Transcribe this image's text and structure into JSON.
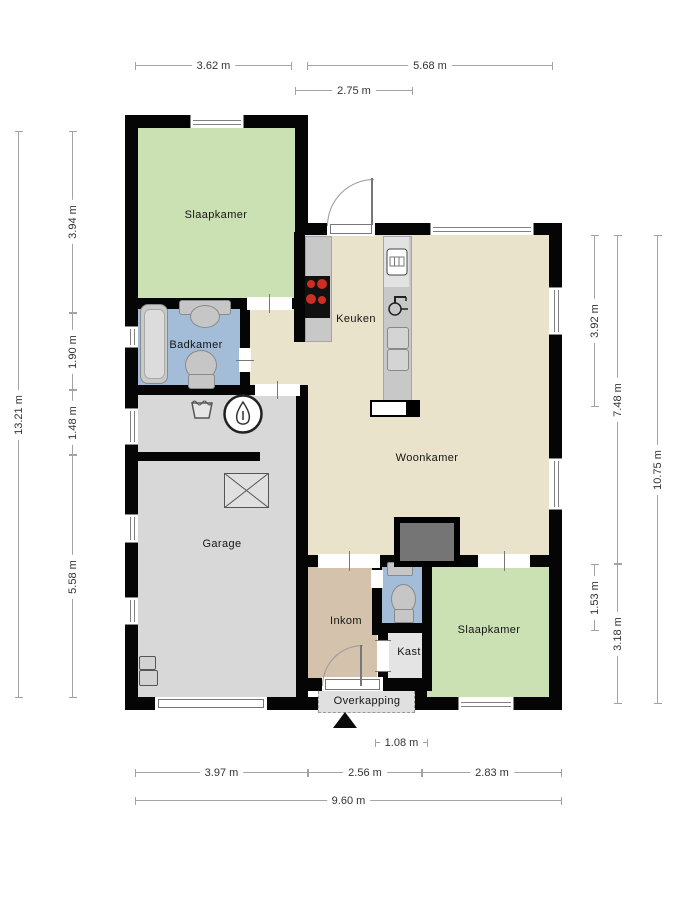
{
  "rooms": {
    "bedroom_top": "Slaapkamer",
    "bathroom": "Badkamer",
    "kitchen": "Keuken",
    "living": "Woonkamer",
    "garage": "Garage",
    "entry": "Inkom",
    "closet": "Kast",
    "bedroom_bottom": "Slaapkamer",
    "canopy": "Overkapping"
  },
  "dimensions": {
    "top": [
      "3.62 m",
      "5.68 m",
      "2.75 m"
    ],
    "left": [
      "13.21 m",
      "3.94 m",
      "1.90 m",
      "1.48 m",
      "5.58 m"
    ],
    "right": [
      "3.92 m",
      "7.48 m",
      "10.75 m",
      "1.53 m",
      "3.18 m"
    ],
    "bottom": [
      "1.08 m",
      "3.97 m",
      "2.56 m",
      "2.83 m",
      "9.60 m"
    ]
  },
  "colors": {
    "wall": "#050505",
    "bedroom_green": "#cbe0b3",
    "bathroom_blue": "#a3bcd8",
    "living_beige": "#eae3cb",
    "garage_gray": "#d8d8d8",
    "closet_gray": "#e4e4e4",
    "entry_tan": "#d4c2ac",
    "canopy_gray": "#e0e0e0",
    "counter_gray": "#c8c8c8",
    "fireplace_gray": "#757575",
    "burner_red": "#cf2d22"
  },
  "icons": {
    "north_arrow": "solid black triangle",
    "stove": "cooktop with four red burners",
    "oven": "oven with display",
    "kitchen_sink": "tap over basin",
    "fridge": "double cooling drawers",
    "bathtub": "rounded tub",
    "washbasin": "pedestal basin",
    "toilet": "toilet bowl with tank",
    "washing_basket": "laundry basket",
    "boiler": "circle with water drop",
    "skylight": "crossed rectangle",
    "utility_meters": "meter boxes"
  }
}
